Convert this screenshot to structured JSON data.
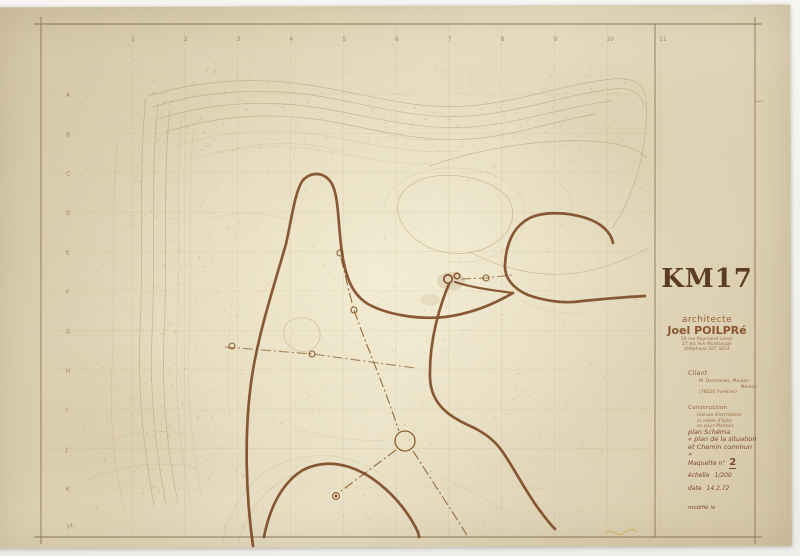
{
  "sheet": {
    "title": "KM17",
    "architect": {
      "role": "architecte",
      "name": "Joel POILPRé",
      "address_lines": [
        "16 rue Raymond Lavoir",
        "27 bis Ave Montsauge",
        "téléphone 587 4854"
      ]
    },
    "client": {
      "heading": "Client",
      "lines": [
        "M. Desmarais, Meulan",
        "Meulan",
        "(78250 Yvelines)"
      ]
    },
    "construction": {
      "heading": "Construction",
      "lines": [
        "maison d'architecte",
        "la vallée d'Epte",
        "en pays Mantois"
      ]
    },
    "notes": {
      "line1": "plan Schéma",
      "line2": "« plan de la situation",
      "line3": "et Chemin commun »",
      "maquette_label": "Maquette n°",
      "maquette_number": "2",
      "scale_label": "échelle",
      "scale_value": "1/200",
      "date_label": "date",
      "date_value": "14.2.72",
      "modified_label": "modifié le"
    }
  },
  "map_frame": {
    "top_numbers": [
      "1",
      "2",
      "3",
      "4",
      "5",
      "6",
      "7",
      "8",
      "9",
      "10",
      "11"
    ],
    "left_letters": [
      "A",
      "B",
      "C",
      "D",
      "E",
      "F",
      "G",
      "H",
      "I",
      "J",
      "K"
    ],
    "corner_mark": "H"
  },
  "colors": {
    "paper": "#e1d6b8",
    "ink_dark_road": "#7a4520",
    "ink_survey": "#8a5c2e",
    "ink_contour": "#ad9164",
    "ink_frame": "#7d6844",
    "ink_title": "#5c3d23",
    "pencil_yellow": "#c6ae4e"
  }
}
